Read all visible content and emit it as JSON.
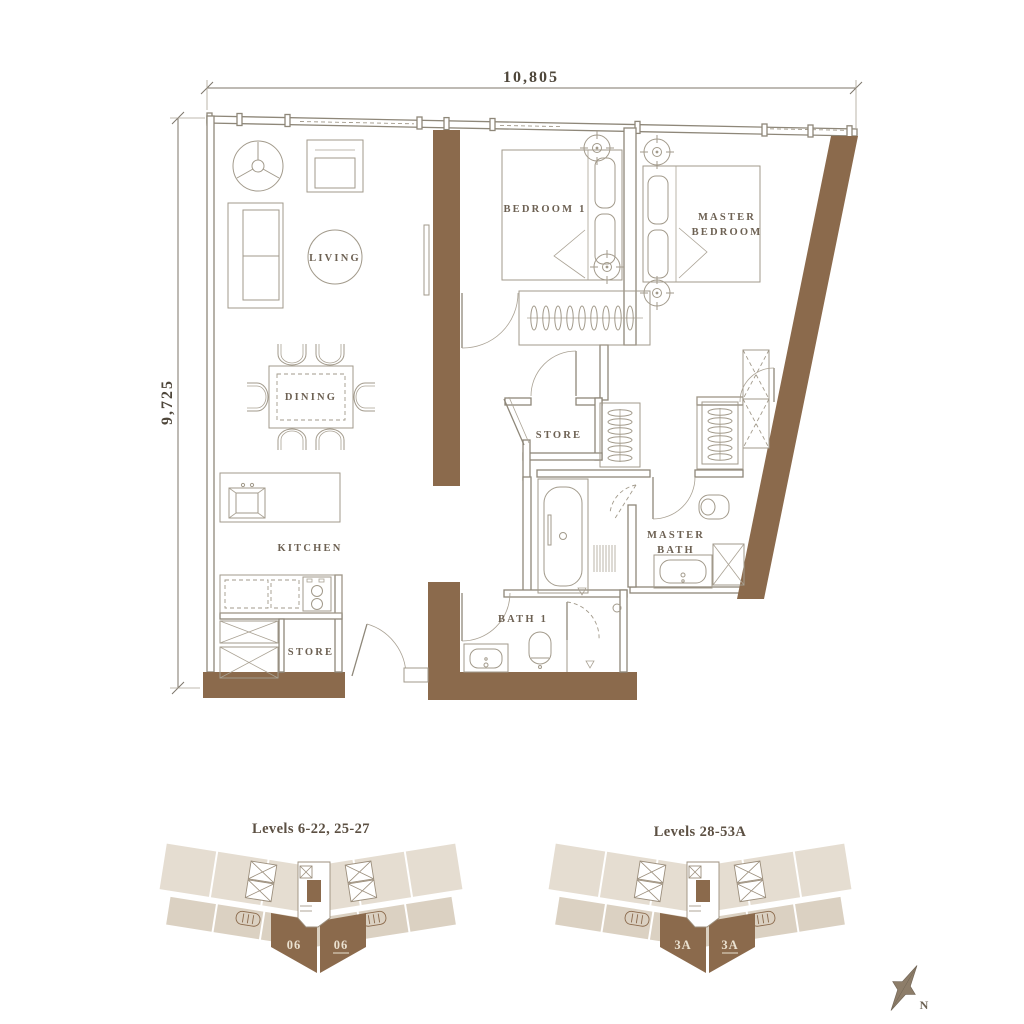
{
  "colors": {
    "wall_brown": "#8b6a4c",
    "plan_line": "#8e8779",
    "label_text": "#6d6153",
    "keyplan_beige_light": "#e5ddd1",
    "keyplan_beige_dark": "#dbd1c2",
    "unit_label": "#eae1d0"
  },
  "dimensions": {
    "width": "10,805",
    "height": "9,725"
  },
  "rooms": {
    "living": "LIVING",
    "dining": "DINING",
    "kitchen": "KITCHEN",
    "store_inner": "STORE",
    "store_entry": "STORE",
    "bedroom1": "BEDROOM 1",
    "master_bedroom": [
      "MASTER",
      "BEDROOM"
    ],
    "master_bath": [
      "MASTER",
      "BATH"
    ],
    "bath1": "BATH 1"
  },
  "key_plans": [
    {
      "title": "Levels 6-22, 25-27",
      "units": [
        "06",
        "06"
      ]
    },
    {
      "title": "Levels 28-53A",
      "units": [
        "3A",
        "3A"
      ]
    }
  ],
  "compass": {
    "north": "N"
  }
}
